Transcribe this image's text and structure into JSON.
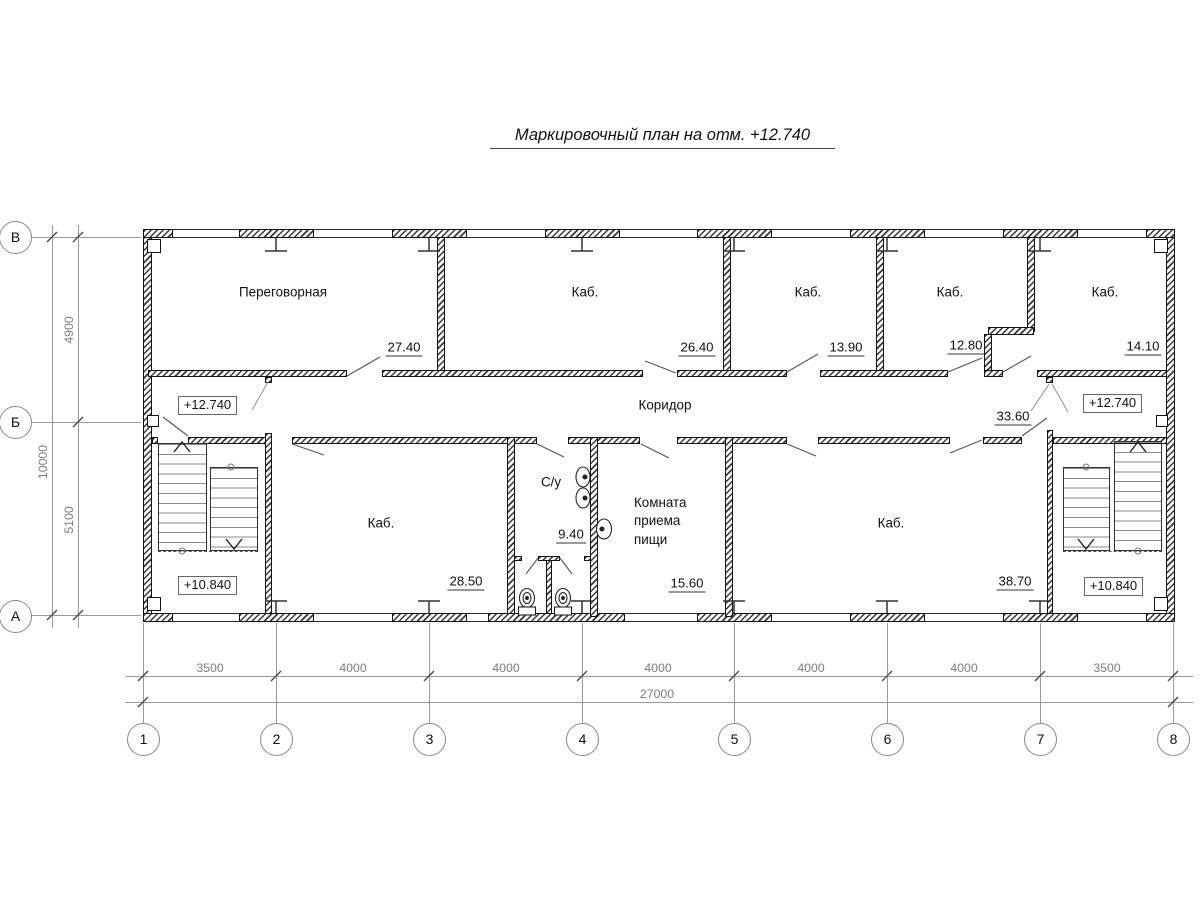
{
  "title": "Маркировочный план на отм. +12.740",
  "rooms": [
    {
      "name": "Переговорная",
      "area": "27.40"
    },
    {
      "name": "Каб.",
      "area": "26.40"
    },
    {
      "name": "Каб.",
      "area": "13.90"
    },
    {
      "name": "Каб.",
      "area": "12.80"
    },
    {
      "name": "Каб.",
      "area": "14.10"
    },
    {
      "name": "Коридор",
      "area": "33.60"
    },
    {
      "name": "Каб.",
      "area": "28.50"
    },
    {
      "name": "С/у",
      "area": "9.40"
    },
    {
      "name": "Комната приема пищи",
      "name_lines": [
        "Комната",
        "приема",
        "пищи"
      ],
      "area": "15.60"
    },
    {
      "name": "Каб.",
      "area": "38.70"
    }
  ],
  "elevations": {
    "upper": "+12.740",
    "lower": "+10.840"
  },
  "axes": {
    "columns": [
      "1",
      "2",
      "3",
      "4",
      "5",
      "6",
      "7",
      "8"
    ],
    "rows": [
      "В",
      "Б",
      "А"
    ]
  },
  "dimensions": {
    "horizontal": [
      "3500",
      "4000",
      "4000",
      "4000",
      "4000",
      "4000",
      "3500"
    ],
    "horizontal_total": "27000",
    "vertical": [
      "4900",
      "5100"
    ],
    "vertical_total": "10000"
  }
}
